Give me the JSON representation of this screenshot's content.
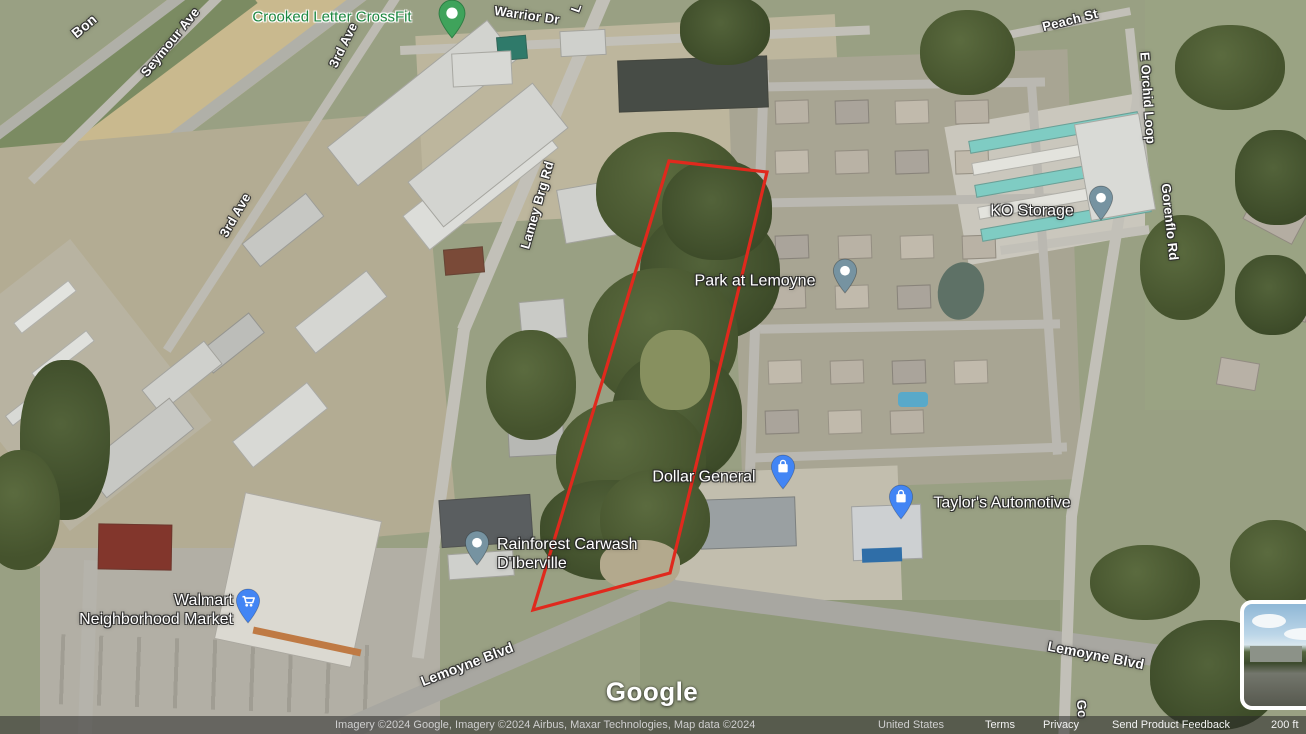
{
  "app": "google-maps-satellite",
  "labels": {
    "crossfit": "Crooked Letter CrossFit",
    "warrior_dr": "Warrior Dr",
    "seymour_ave": "Seymour Ave",
    "third_ave": "3rd Ave",
    "bon_partial": "Bon",
    "l_partial": "L",
    "lamey_brg_rd": "Lamey Brg Rd",
    "peach_st": "Peach St",
    "e_orchid_loop": "E Orchid Loop",
    "ko_storage": "KO Storage",
    "gorenflo_rd": "Gorenflo Rd",
    "go_partial": "Go",
    "park_at_lemoyne": "Park at Lemoyne",
    "dollar_general": "Dollar General",
    "taylors_automotive": "Taylor's Automotive",
    "rainforest_carwash_line1": "Rainforest Carwash",
    "rainforest_carwash_line2": "D'Iberville",
    "walmart_line1": "Walmart",
    "walmart_line2": "Neighborhood Market",
    "lemoyne_blvd": "Lemoyne Blvd"
  },
  "watermark": "Google",
  "attribution": {
    "imagery": "Imagery ©2024 Google, Imagery ©2024 Airbus, Maxar Technologies, Map data ©2024",
    "country": "United States",
    "terms": "Terms",
    "privacy": "Privacy",
    "feedback": "Send Product Feedback",
    "scale": "200 ft"
  },
  "colors": {
    "parcel_outline": "#e0291d",
    "pin_blue": "#4285f4",
    "pin_gray": "#7693a1",
    "pin_green": "#3fa35b",
    "poi_green_text": "#1c8740"
  }
}
